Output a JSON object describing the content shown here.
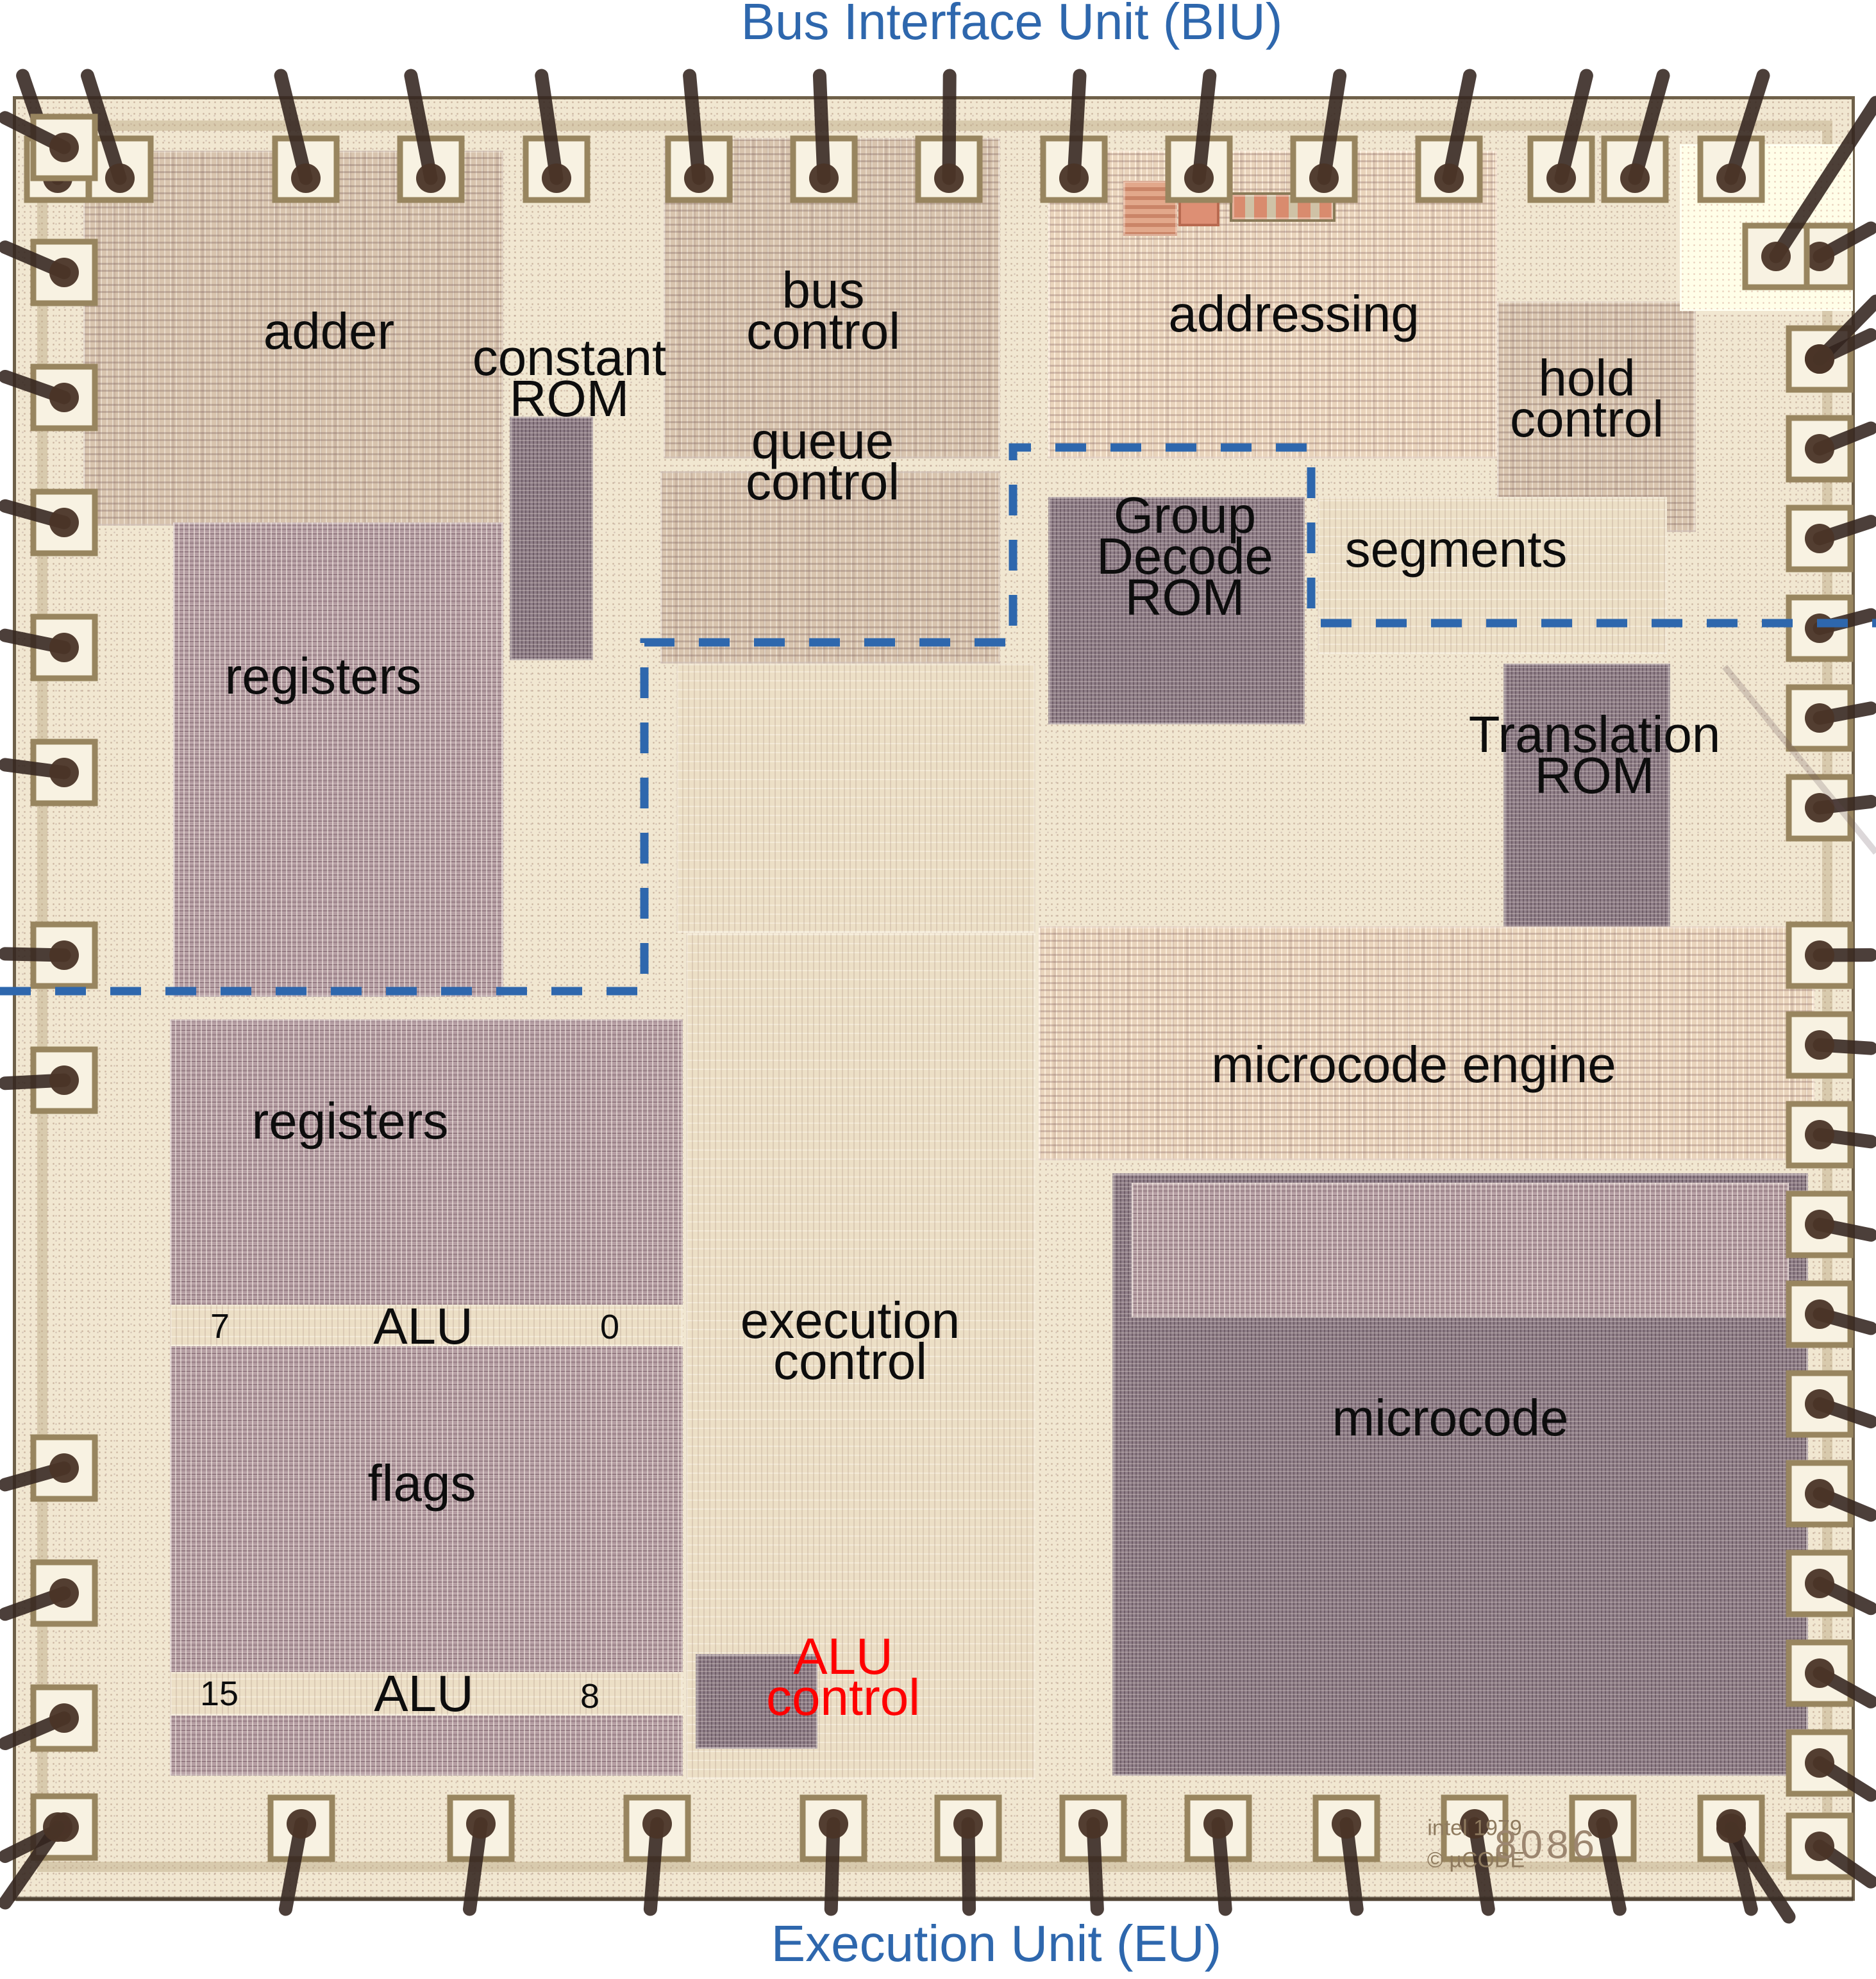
{
  "titles": {
    "top": "Bus Interface Unit (BIU)",
    "bottom": "Execution Unit (EU)"
  },
  "regions": {
    "adder": "adder",
    "constant_rom": [
      "constant",
      "ROM"
    ],
    "bus_control": [
      "bus",
      "control"
    ],
    "queue_control": [
      "queue",
      "control"
    ],
    "addressing": "addressing",
    "hold_control": [
      "hold",
      "control"
    ],
    "group_decode_rom": [
      "Group",
      "Decode",
      "ROM"
    ],
    "segments": "segments",
    "registers_biu": "registers",
    "translation_rom": [
      "Translation",
      "ROM"
    ],
    "microcode_engine": "microcode engine",
    "registers_eu": "registers",
    "alu_high": {
      "left_bit": "7",
      "label": "ALU",
      "right_bit": "0"
    },
    "execution_control": [
      "execution",
      "control"
    ],
    "flags": "flags",
    "microcode": "microcode",
    "alu_low": {
      "left_bit": "15",
      "label": "ALU",
      "right_bit": "8"
    },
    "alu_control": [
      "ALU",
      "control"
    ]
  },
  "die_marking": {
    "copyright": "intel 1979",
    "mucode": "© µCODE",
    "part_number": "8086"
  },
  "colors": {
    "annotation_blue": "#2e67ad",
    "annotation_red": "#ff0000",
    "label_black": "#0d0d0d",
    "dash_blue": "#2e67ad"
  }
}
